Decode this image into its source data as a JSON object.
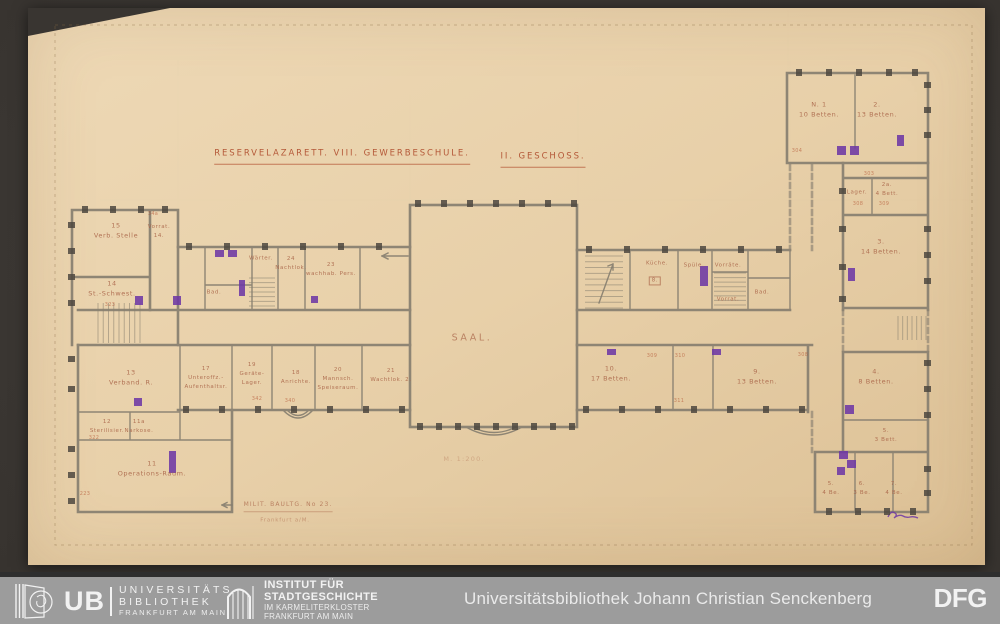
{
  "colors": {
    "bg": "#393531",
    "paper": "#e9d2ac",
    "ink_red": "#b04e2e",
    "ink_faint": "#a86246",
    "wall_gray": "#877f70",
    "pier_dark": "#4e483f",
    "accent_purple": "#6d38a5",
    "footer_bg": "#9c9c9c",
    "footer_strip": "#2e2e2e",
    "footer_text": "#f2f2f2"
  },
  "drawing": {
    "title": "RESERVELAZARETT. VIII. GEWERBESCHULE.",
    "floor": "II. GESCHOSS.",
    "hall": "SAAL.",
    "scale": "M. 1:200.",
    "caption1": "MILIT. BAULTG. No 23.",
    "caption2": "Frankfurt a/M.",
    "rooms": {
      "verb_stelle": "15\nVerb. Stelle",
      "vorrat14": "Vorrat.\n14.",
      "st_schwest": "14\nSt.-Schwest.",
      "verband": "13\nVerband. R.",
      "sterilisier": "12\nSterilisier.",
      "narkose": "11a\nNarkose.",
      "operation": "11\nOperations-Raum.",
      "waerter": "Wärter.",
      "nachtlok": "24\nNachtlok.",
      "wachhab": "23\nwachhab. Pers.",
      "bad_left": "Bad.",
      "unteroffz": "17\nUnteroffz.-\nAufenthaltsr.",
      "geraete": "19\nGeräte-\nLager.",
      "anrichte": "18\nAnrichte.",
      "speiseraum": "20\nMannsch.\nSpeiseraum.",
      "wachtlokal": "21\nWachtlok. 2.",
      "kueche": "Küche.",
      "kueche_no": "8.",
      "spuele": "Spüle.",
      "vorraete": "Vorräte.",
      "vorrat_r": "Vorrat.",
      "bad_right": "Bad.",
      "r10": "10.\n17 Betten.",
      "r9": "9.\n13 Betten.",
      "n1": "N. 1\n10 Betten.",
      "r2": "2.\n13 Betten.",
      "lager": "Lager.",
      "r2a": "2a.\n4 Bett.",
      "r3": "3.\n14 Betten.",
      "r4": "4.\n8 Betten.",
      "r5": "5.\n3 Bett.",
      "r5b": "5.\n4 Be.",
      "r6": "6.\n3 Be.",
      "r7": "7.\n4 Be."
    },
    "tiny_numbers": [
      "34a",
      "304",
      "303",
      "308",
      "309",
      "309",
      "310",
      "308",
      "311",
      "342",
      "340",
      "323",
      "322",
      "223"
    ]
  },
  "footer": {
    "ub_acronym": "UB",
    "ub_lines": [
      "UNIVERSITÄTS",
      "BIBLIOTHEK",
      "FRANKFURT AM MAIN"
    ],
    "institute_lines": [
      "INSTITUT FÜR",
      "STADTGESCHICHTE",
      "IM KARMELITERKLOSTER",
      "FRANKFURT AM MAIN"
    ],
    "library_name": "Universitätsbibliothek Johann Christian Senckenberg",
    "dfg_label": "DFG"
  }
}
